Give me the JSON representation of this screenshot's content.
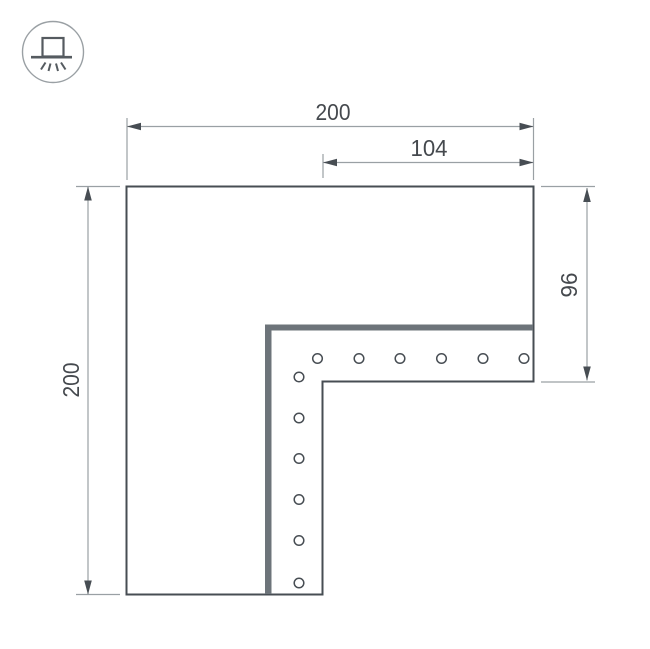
{
  "drawing": {
    "kind": "dimension-drawing",
    "dimensions": {
      "top_width": "200",
      "top_inner_width": "104",
      "left_height": "200",
      "right_inner_height": "96"
    },
    "icon": {
      "name": "surface-mounted-light-icon"
    },
    "holes": {
      "count": 12
    },
    "colors": {
      "outline": "#474d53",
      "dimension_line": "#9aa0a4",
      "band": "#6d747a",
      "text": "#45494e",
      "background": "#ffffff"
    }
  }
}
